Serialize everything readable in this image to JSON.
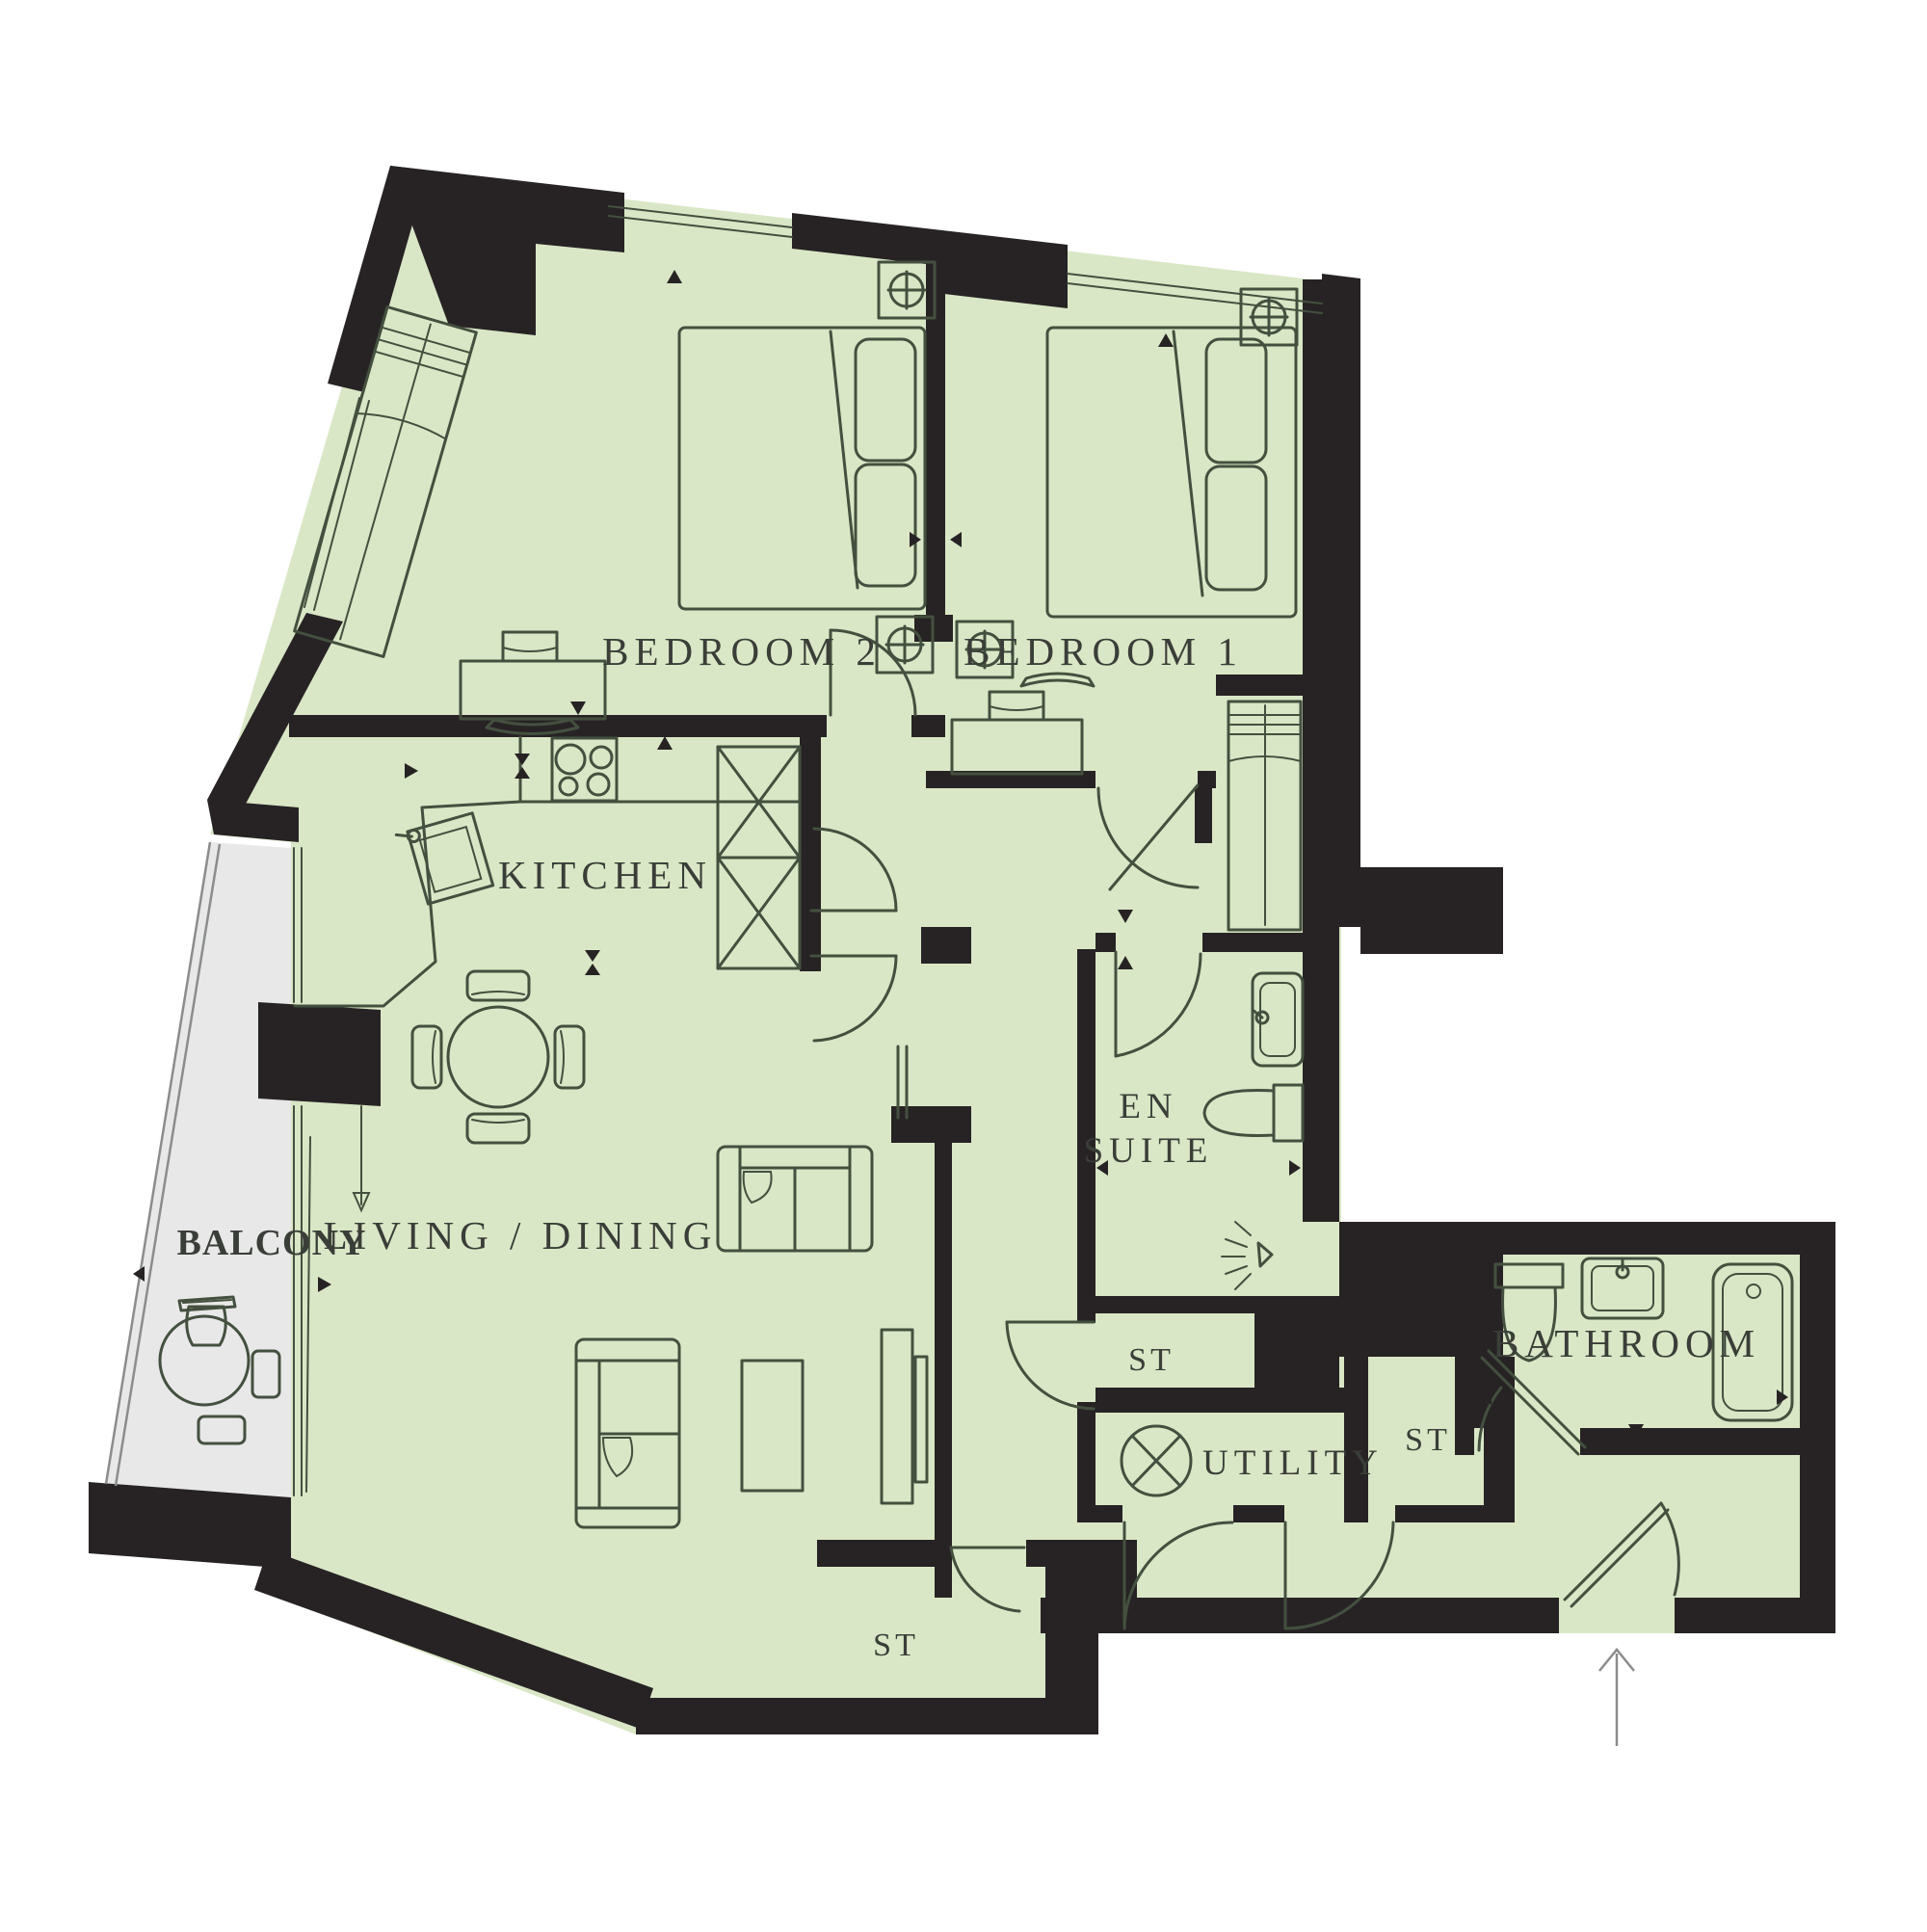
{
  "title": "Two bedroom apartment floor plan",
  "colors": {
    "floor": "#d9e7c6",
    "balcony": "#e7e8e7",
    "wall": "#272324",
    "line": "#44503f",
    "label": "#3a3e38",
    "page": "#ffffff"
  },
  "rooms": [
    {
      "id": "bedroom2",
      "label": "BEDROOM 2"
    },
    {
      "id": "bedroom1",
      "label": "BEDROOM 1"
    },
    {
      "id": "kitchen",
      "label": "KITCHEN"
    },
    {
      "id": "living",
      "label": "LIVING / DINING"
    },
    {
      "id": "balcony",
      "label": "BALCONY"
    },
    {
      "id": "ensuite",
      "label": "EN SUITE",
      "line1": "EN",
      "line2": "SUITE"
    },
    {
      "id": "bathroom",
      "label": "BATHROOM"
    },
    {
      "id": "utility",
      "label": "UTILITY"
    },
    {
      "id": "store1",
      "label": "ST"
    },
    {
      "id": "store2",
      "label": "ST"
    },
    {
      "id": "store3",
      "label": "ST"
    }
  ],
  "symbols": {
    "ceiling_light": "circle-cross lamp symbol on bedside units",
    "washer": "circle with X in utility room",
    "shower": "shower spray head in en suite",
    "entry_arrow": "arrow pointing up at entrance door"
  }
}
